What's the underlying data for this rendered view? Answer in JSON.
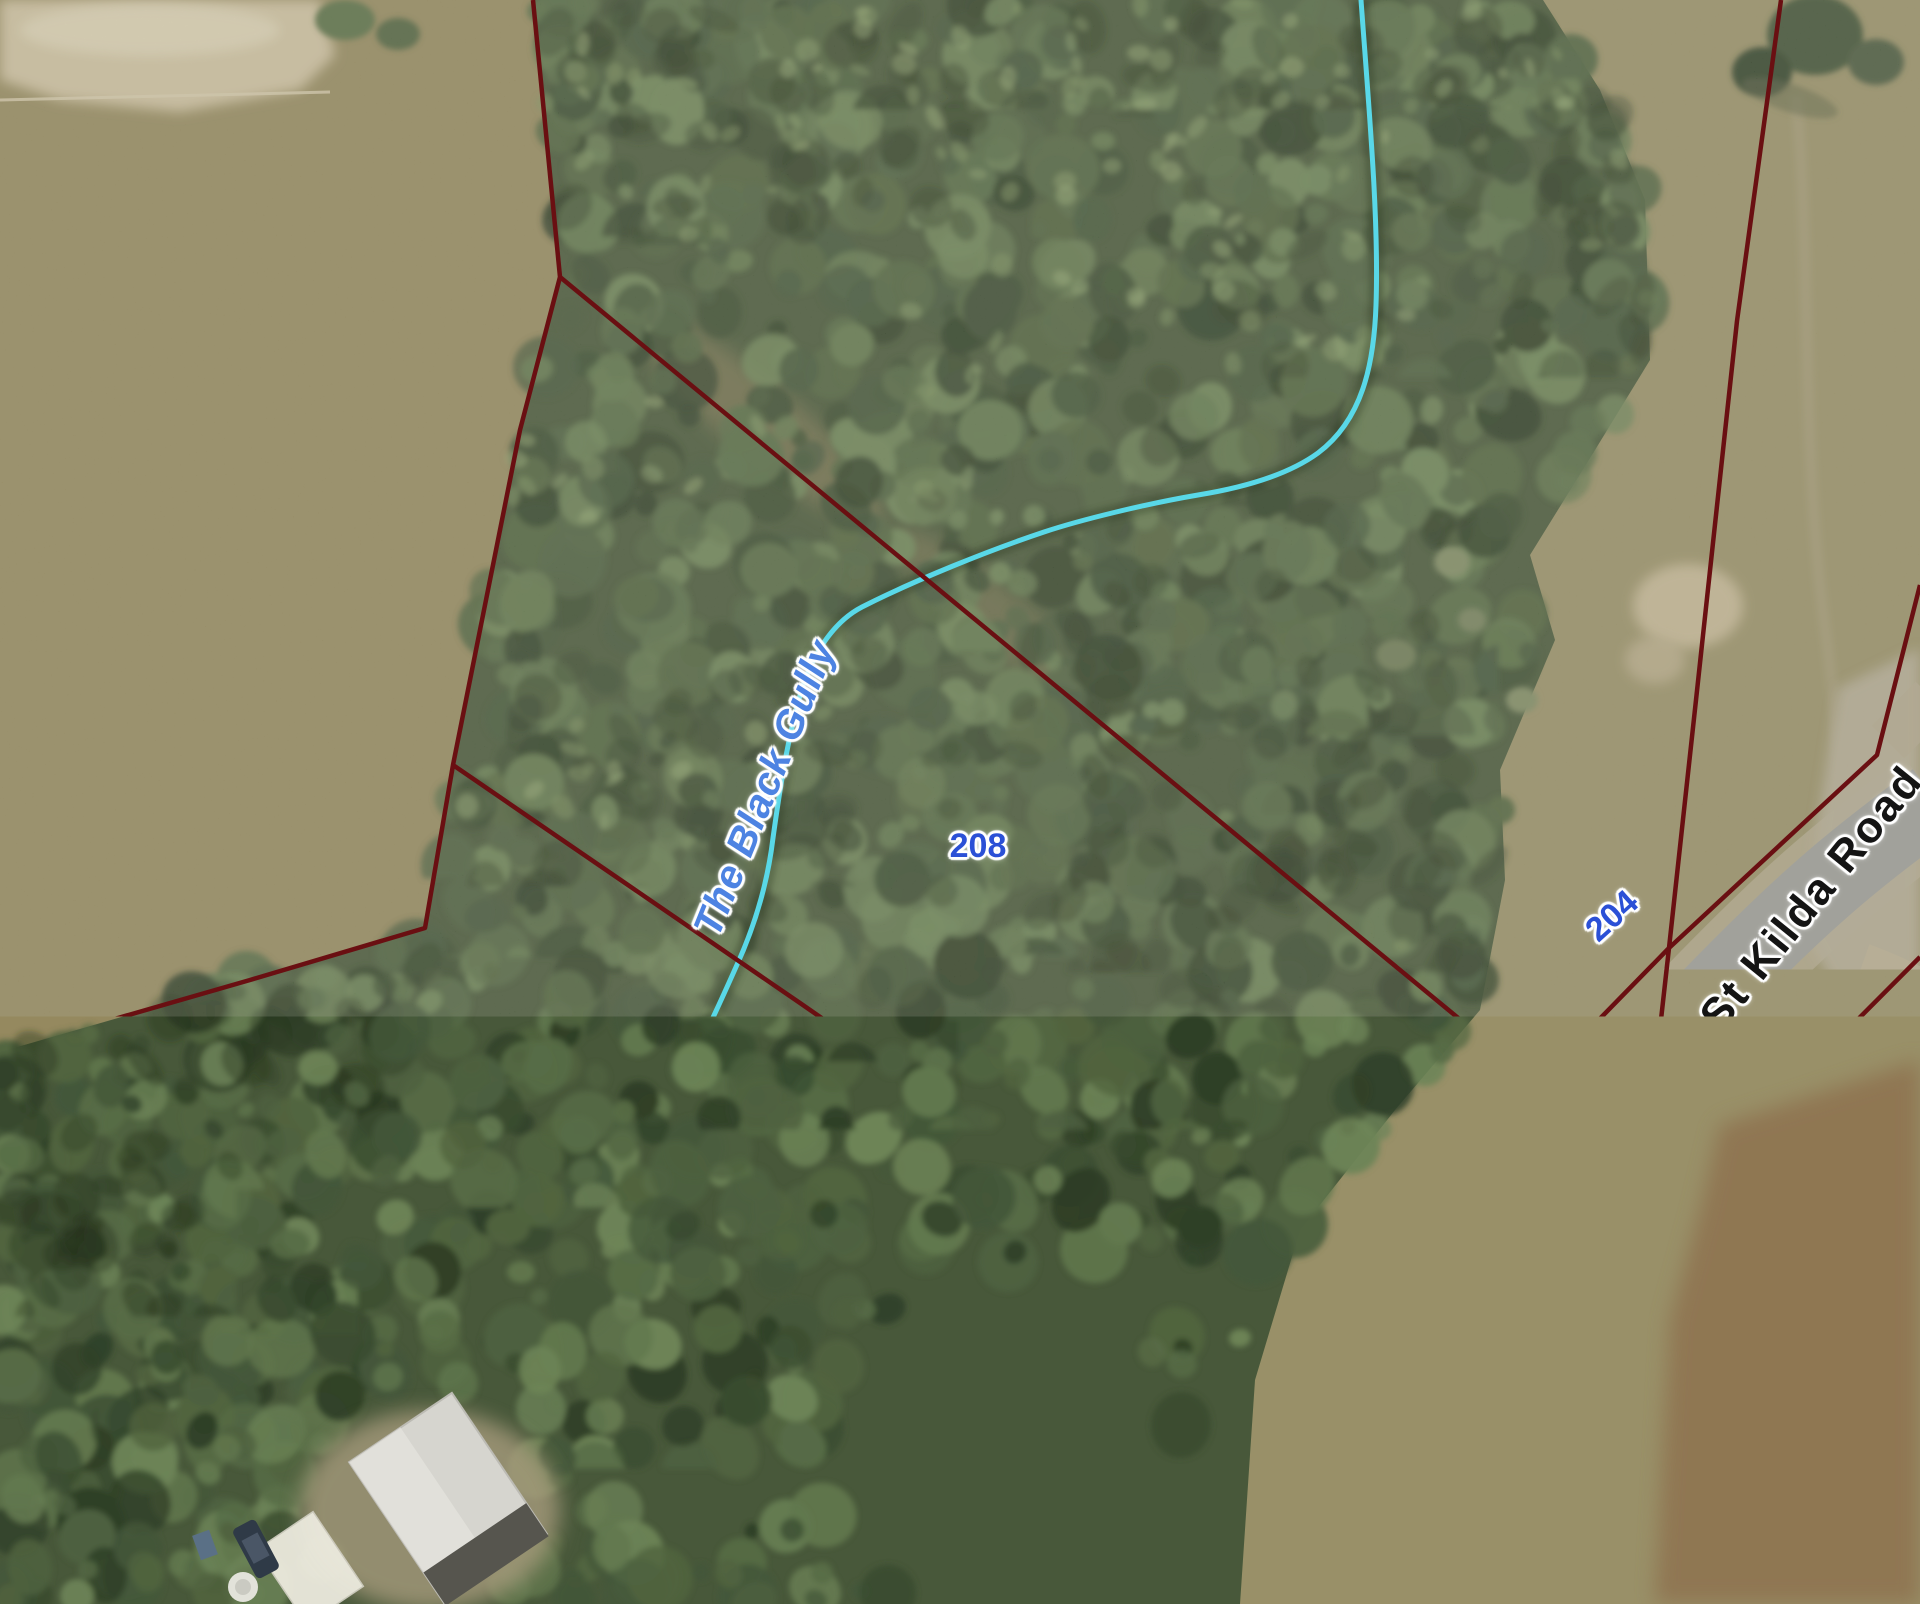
{
  "map": {
    "parcels": [
      {
        "label": "208"
      },
      {
        "label": "204"
      },
      {
        "label": "212"
      },
      {
        "label": "216"
      }
    ],
    "waterway": {
      "label": "The Black Gully"
    },
    "road": {
      "label": "St Kilda Road"
    },
    "colors": {
      "boundary": "#6a0f12",
      "waterway": "#59d8e8",
      "parcel_label": "#2b50d6",
      "waterway_label": "#4d83e2",
      "road_label": "#141414"
    }
  }
}
